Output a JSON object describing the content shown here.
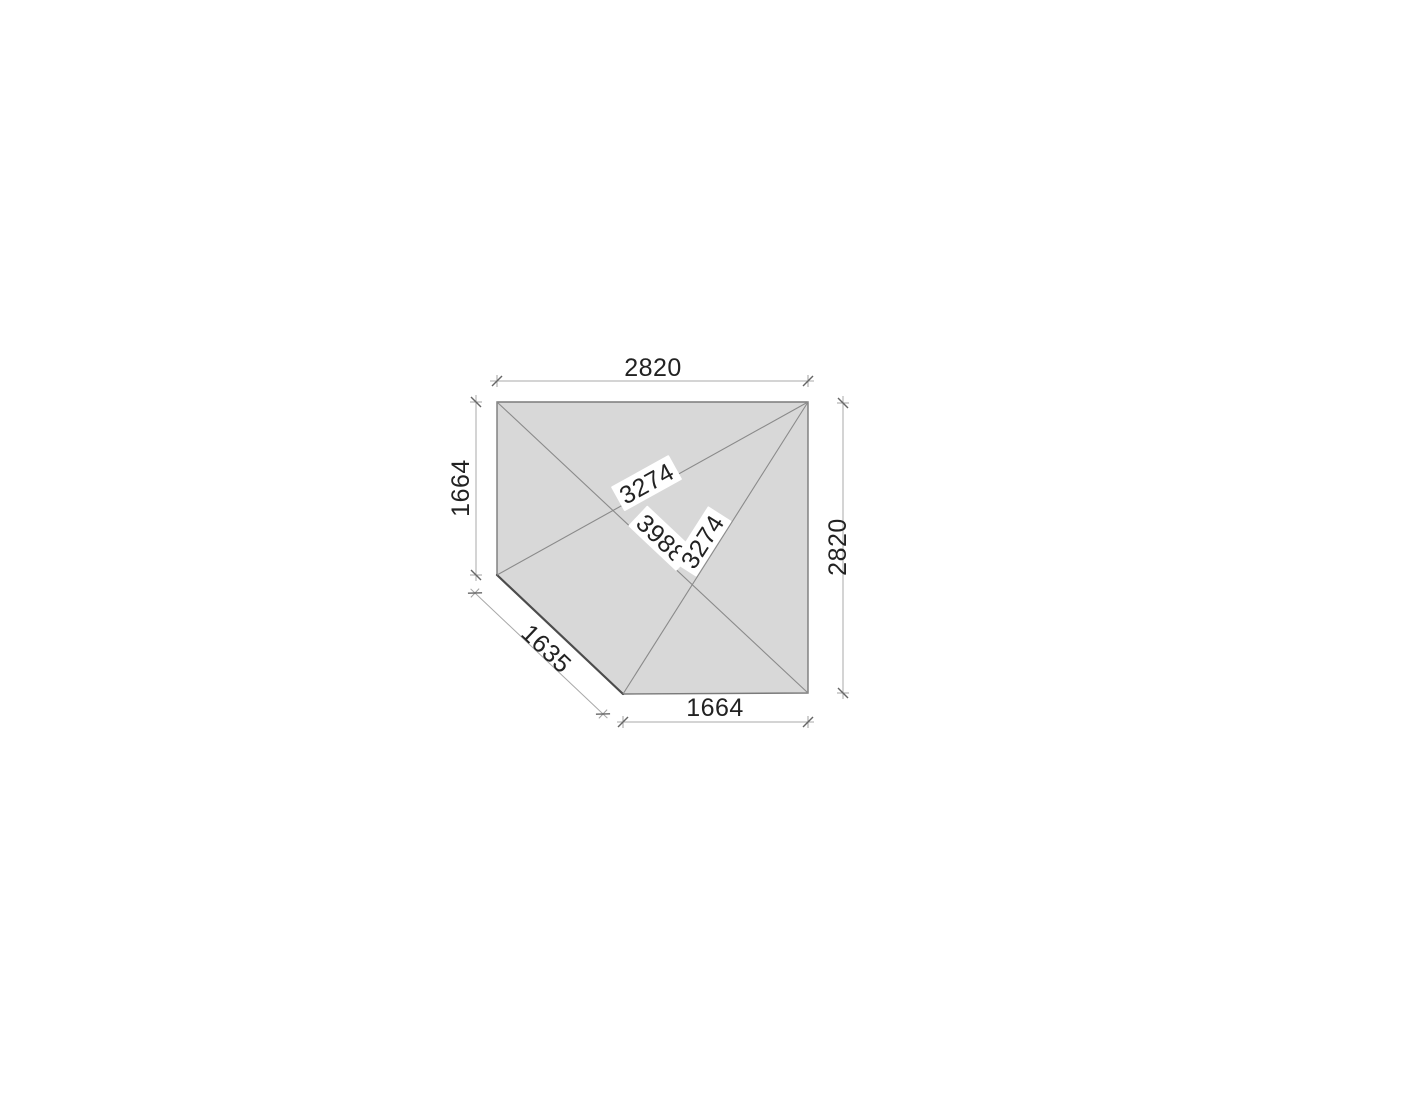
{
  "page": {
    "background": "#ffffff"
  },
  "drawing": {
    "type": "corner-panel-plan",
    "dimensions": {
      "top_width": "2820",
      "left_height": "1664",
      "right_height": "2820",
      "bottom_width": "1664",
      "corner_edge": "1635"
    },
    "diagonals": {
      "top": "3274",
      "main": "3988",
      "bottom": "3274"
    },
    "colors": {
      "panel_fill": "#d8d8d8",
      "panel_outline": "#7a7a7a",
      "cut_edge": "#4c4c4c",
      "diagonal_line": "#8a8a8a",
      "dimension_line": "#a8a8a8",
      "tick": "#666666",
      "label_text": "#222222",
      "label_halo": "#ffffff"
    }
  }
}
